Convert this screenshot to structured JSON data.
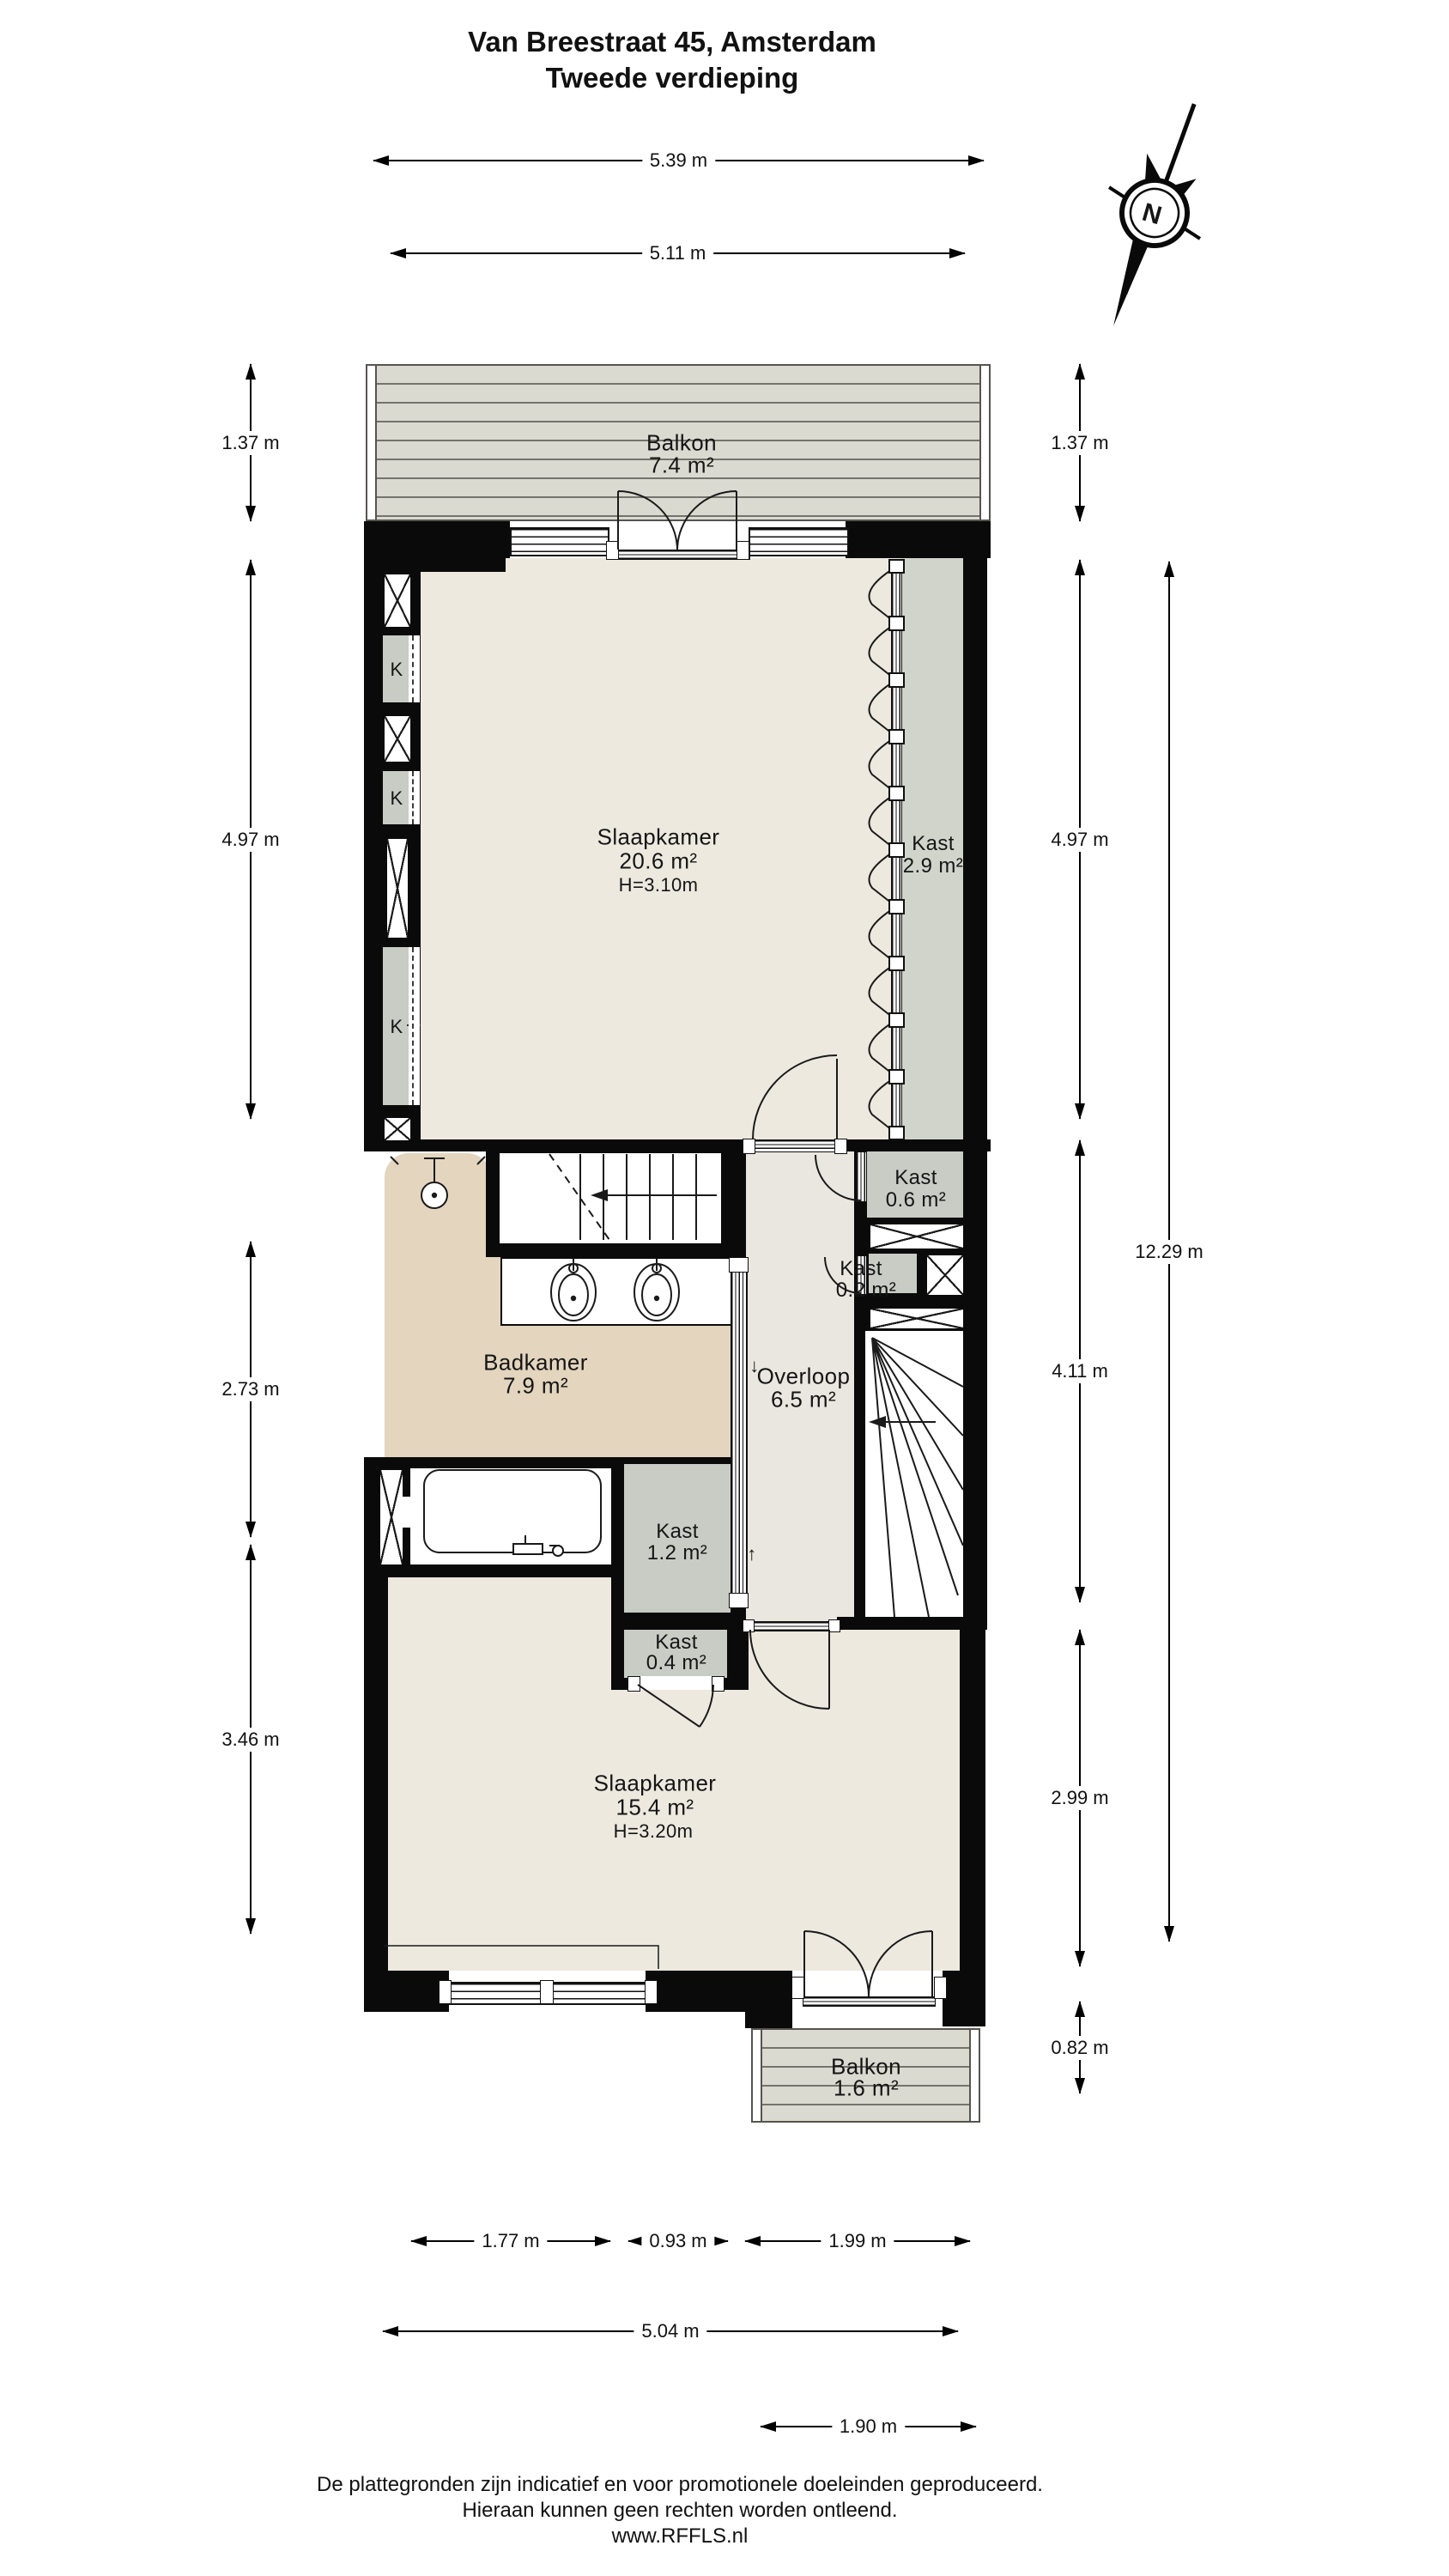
{
  "title": {
    "line1": "Van Breestraat 45, Amsterdam",
    "line2": "Tweede verdieping"
  },
  "compass": {
    "label": "N"
  },
  "rooms": {
    "balkon_top": {
      "name": "Balkon",
      "area": "7.4 m²"
    },
    "slaapkamer_1": {
      "name": "Slaapkamer",
      "area": "20.6 m²",
      "height": "H=3.10m"
    },
    "kast_29": {
      "name": "Kast",
      "area": "2.9 m²"
    },
    "kast_06": {
      "name": "Kast",
      "area": "0.6 m²"
    },
    "kast_02": {
      "name": "Kast",
      "area": "0.2 m²"
    },
    "badkamer": {
      "name": "Badkamer",
      "area": "7.9 m²"
    },
    "overloop": {
      "name": "Overloop",
      "area": "6.5 m²"
    },
    "kast_12": {
      "name": "Kast",
      "area": "1.2 m²"
    },
    "kast_04": {
      "name": "Kast",
      "area": "0.4 m²"
    },
    "slaapkamer_2": {
      "name": "Slaapkamer",
      "area": "15.4 m²",
      "height": "H=3.20m"
    },
    "balkon_bottom": {
      "name": "Balkon",
      "area": "1.6 m²"
    }
  },
  "closet_label": "K",
  "stair_arrows": {
    "down": "↓",
    "up": "↑"
  },
  "dimensions": {
    "top_outer": "5.39 m",
    "top_inner": "5.11 m",
    "left_1": "1.37 m",
    "left_2": "4.97 m",
    "left_3": "2.73 m",
    "left_4": "3.46 m",
    "right_1": "1.37 m",
    "right_2": "4.97 m",
    "right_3": "4.11 m",
    "right_4": "2.99 m",
    "right_5": "0.82 m",
    "right_total": "12.29 m",
    "bottom_1": "1.77 m",
    "bottom_2": "0.93 m",
    "bottom_3": "1.99 m",
    "bottom_4": "5.04 m",
    "bottom_5": "1.90 m"
  },
  "footer": {
    "line1": "De plattegronden zijn indicatief en voor promotionele doeleinden geproduceerd.",
    "line2": "Hieraan kunnen geen rechten worden ontleend.",
    "line3": "www.RFFLS.nl"
  },
  "colors": {
    "wall": "#0A0A0A",
    "bedroom_floor": "#EDE9DF",
    "bathroom_floor": "#E3D5BE",
    "hallway_floor": "#EAE7E0",
    "closet_floor": "#C9CCC4",
    "wardrobe_floor": "#D1D4CB",
    "balcony_deck": "#DBDAD1",
    "linework": "#1A1A1A"
  }
}
